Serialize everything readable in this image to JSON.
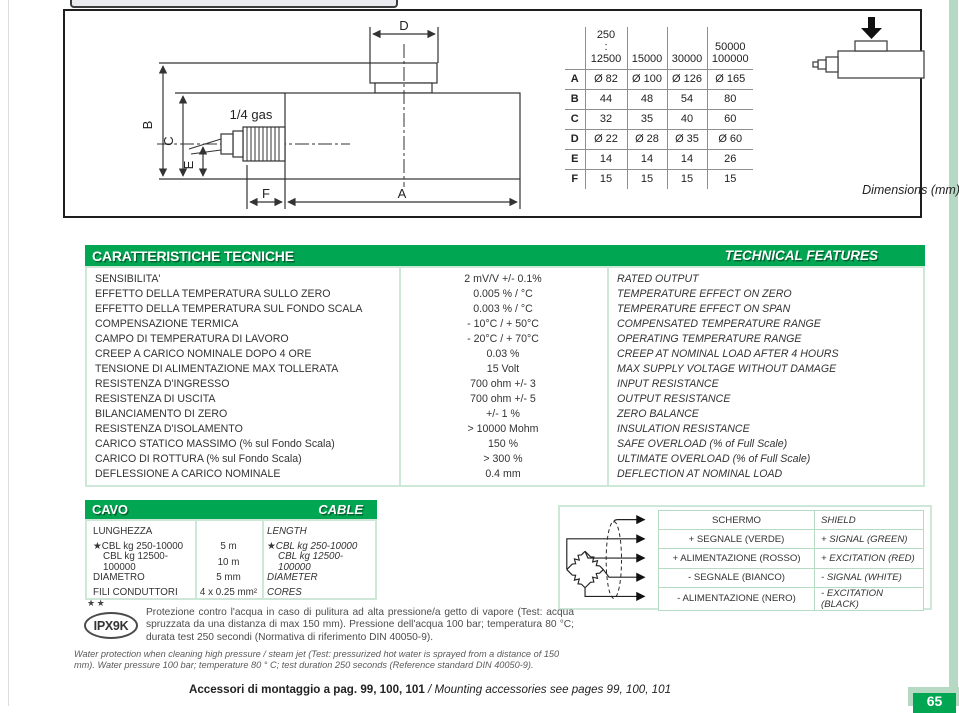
{
  "colors": {
    "accent_green": "#00a651",
    "light_green_border": "#cde8d7",
    "stripe_green": "#b5d9c2",
    "grid_gray": "#8f8f8f",
    "page_bg": "#ffffff"
  },
  "page": {
    "page_number": "65"
  },
  "drawing": {
    "labels": {
      "d": "D",
      "b": "B",
      "c": "C",
      "e": "E",
      "f": "F",
      "a": "A",
      "gas": "1/4 gas"
    },
    "dimensions_note": "Dimensions (mm)",
    "table": {
      "col_headers": [
        "250\n:\n12500",
        "15000",
        "30000",
        "50000\n100000"
      ],
      "rows": [
        {
          "label": "A",
          "values": [
            "Ø 82",
            "Ø 100",
            "Ø 126",
            "Ø 165"
          ]
        },
        {
          "label": "B",
          "values": [
            "44",
            "48",
            "54",
            "80"
          ]
        },
        {
          "label": "C",
          "values": [
            "32",
            "35",
            "40",
            "60"
          ]
        },
        {
          "label": "D",
          "values": [
            "Ø 22",
            "Ø 28",
            "Ø 35",
            "Ø 60"
          ]
        },
        {
          "label": "E",
          "values": [
            "14",
            "14",
            "14",
            "26"
          ]
        },
        {
          "label": "F",
          "values": [
            "15",
            "15",
            "15",
            "15"
          ]
        }
      ]
    }
  },
  "tech": {
    "title_it": "CARATTERISTICHE TECNICHE",
    "title_en": "TECHNICAL FEATURES",
    "rows": [
      {
        "it": "SENSIBILITA'",
        "val": "2 mV/V +/- 0.1%",
        "en": "RATED OUTPUT"
      },
      {
        "it": "EFFETTO DELLA TEMPERATURA SULLO ZERO",
        "val": "0.005 % / °C",
        "en": "TEMPERATURE EFFECT ON ZERO"
      },
      {
        "it": "EFFETTO DELLA TEMPERATURA SUL FONDO SCALA",
        "val": "0.003 % / °C",
        "en": "TEMPERATURE EFFECT ON SPAN"
      },
      {
        "it": "COMPENSAZIONE TERMICA",
        "val": "- 10°C / + 50°C",
        "en": "COMPENSATED TEMPERATURE RANGE"
      },
      {
        "it": "CAMPO DI TEMPERATURA DI LAVORO",
        "val": "- 20°C / + 70°C",
        "en": "OPERATING TEMPERATURE RANGE"
      },
      {
        "it": "CREEP A CARICO NOMINALE DOPO 4 ORE",
        "val": "0.03 %",
        "en": "CREEP AT NOMINAL LOAD AFTER 4 HOURS"
      },
      {
        "it": "TENSIONE DI ALIMENTAZIONE MAX TOLLERATA",
        "val": "15 Volt",
        "en": "MAX SUPPLY VOLTAGE WITHOUT DAMAGE"
      },
      {
        "it": "RESISTENZA D'INGRESSO",
        "val": "700 ohm +/- 3",
        "en": "INPUT RESISTANCE"
      },
      {
        "it": "RESISTENZA DI USCITA",
        "val": "700 ohm +/- 5",
        "en": "OUTPUT RESISTANCE"
      },
      {
        "it": "BILANCIAMENTO DI ZERO",
        "val": "+/- 1 %",
        "en": "ZERO BALANCE"
      },
      {
        "it": "RESISTENZA D'ISOLAMENTO",
        "val": "> 10000 Mohm",
        "en": "INSULATION RESISTANCE"
      },
      {
        "it": "CARICO STATICO MASSIMO (% sul Fondo Scala)",
        "val": "150 %",
        "en": "SAFE OVERLOAD (% of Full Scale)"
      },
      {
        "it": "CARICO DI ROTTURA (% sul Fondo Scala)",
        "val": "> 300 %",
        "en": "ULTIMATE OVERLOAD (% of Full Scale)"
      },
      {
        "it": "DEFLESSIONE A CARICO NOMINALE",
        "val": "0.4 mm",
        "en": "DEFLECTION AT NOMINAL LOAD"
      }
    ]
  },
  "cable": {
    "title_it": "CAVO",
    "title_en": "CABLE",
    "rows": [
      {
        "it": "LUNGHEZZA",
        "val": "",
        "en": "LENGTH"
      },
      {
        "it": "★CBL kg 250-10000",
        "val": "5 m",
        "en": "★CBL kg 250-10000"
      },
      {
        "it": "CBL kg 12500-100000",
        "val": "10 m",
        "en": "CBL kg 12500-100000"
      },
      {
        "it": "DIAMETRO",
        "val": "5 mm",
        "en": "DIAMETER"
      },
      {
        "it": "FILI CONDUTTORI",
        "val": "4 x 0.25 mm²",
        "en": "CORES"
      }
    ]
  },
  "wiring": {
    "rows": [
      {
        "it": "SCHERMO",
        "en": "SHIELD"
      },
      {
        "it": "+ SEGNALE (VERDE)",
        "en": "+ SIGNAL (GREEN)"
      },
      {
        "it": "+ ALIMENTAZIONE (ROSSO)",
        "en": "+ EXCITATION (RED)"
      },
      {
        "it": "- SEGNALE (BIANCO)",
        "en": "- SIGNAL (WHITE)"
      },
      {
        "it": "- ALIMENTAZIONE (NERO)",
        "en": "- EXCITATION (BLACK)"
      }
    ]
  },
  "protection": {
    "stars": "★★",
    "badge": "IPX9K",
    "text_it": "Protezione contro l'acqua in caso di pulitura ad alta pressione/a getto di vapore (Test: acqua spruzzata da una distanza di max 150 mm). Pressione dell'acqua 100 bar; temperatura 80 °C; durata test 250 secondi (Normativa di riferimento DIN 40050-9).",
    "text_en": "Water protection when cleaning high pressure / steam jet (Test: pressurized hot water is sprayed from a distance of 150 mm). Water pressure 100 bar; temperature 80 ° C; test duration 250 seconds (Reference standard DIN 40050-9)."
  },
  "footer": {
    "it": "Accessori di montaggio a pag. 99, 100, 101",
    "en": " / Mounting accessories see pages 99, 100, 101"
  }
}
